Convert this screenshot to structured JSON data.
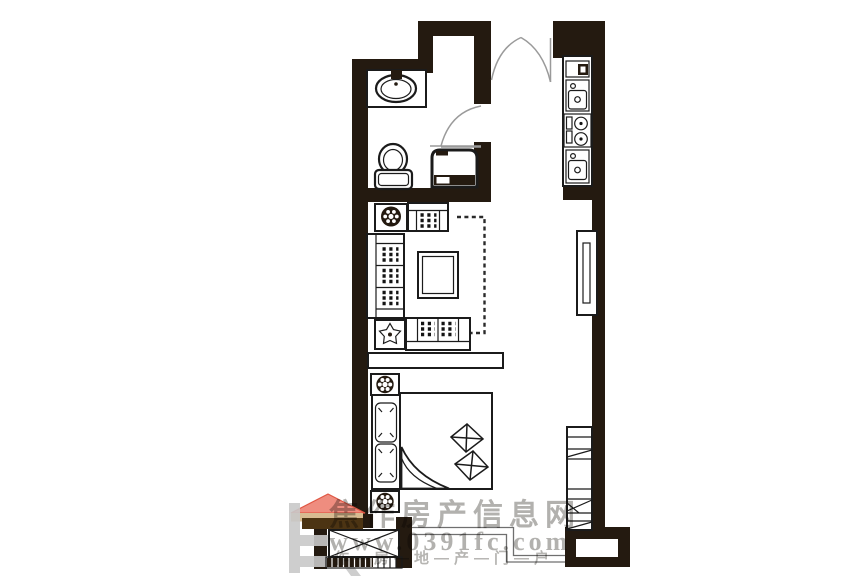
{
  "watermark": {
    "title": "焦作房产信息网",
    "url": "www.0391fc.com",
    "tagline": "作—房—地—产—门—户",
    "text_color": "#b2b1ae"
  },
  "logo": {
    "name": "jiaozuo-house-logo",
    "colors": {
      "roof": "#ef8d7f",
      "roof_edge": "#e05744",
      "beam": "#d7bb91",
      "beam_dark": "#4c3413",
      "strokes": "#c9c9c9"
    }
  },
  "plan": {
    "wall_color": "#241a10",
    "line_color": "#1b1b1b",
    "door_arc_color": "#9a9a9a",
    "fixtures": [
      "entry-double-door",
      "wash-basin",
      "toilet",
      "washing-machine",
      "bathroom-door",
      "kitchen-counter",
      "wall-unit",
      "sink-unit",
      "cooktop",
      "base-unit",
      "potted-plant",
      "armchair",
      "three-seat-sofa",
      "coffee-table",
      "two-seat-sofa",
      "tv-dashed-outline",
      "console-table",
      "nightstand",
      "double-bed",
      "pillow",
      "quilt-fold",
      "quilt-decor",
      "wardrobe",
      "bay-window-hatch",
      "side-window",
      "storage-cabinet",
      "balcony-glass-rail",
      "entry-column"
    ]
  }
}
